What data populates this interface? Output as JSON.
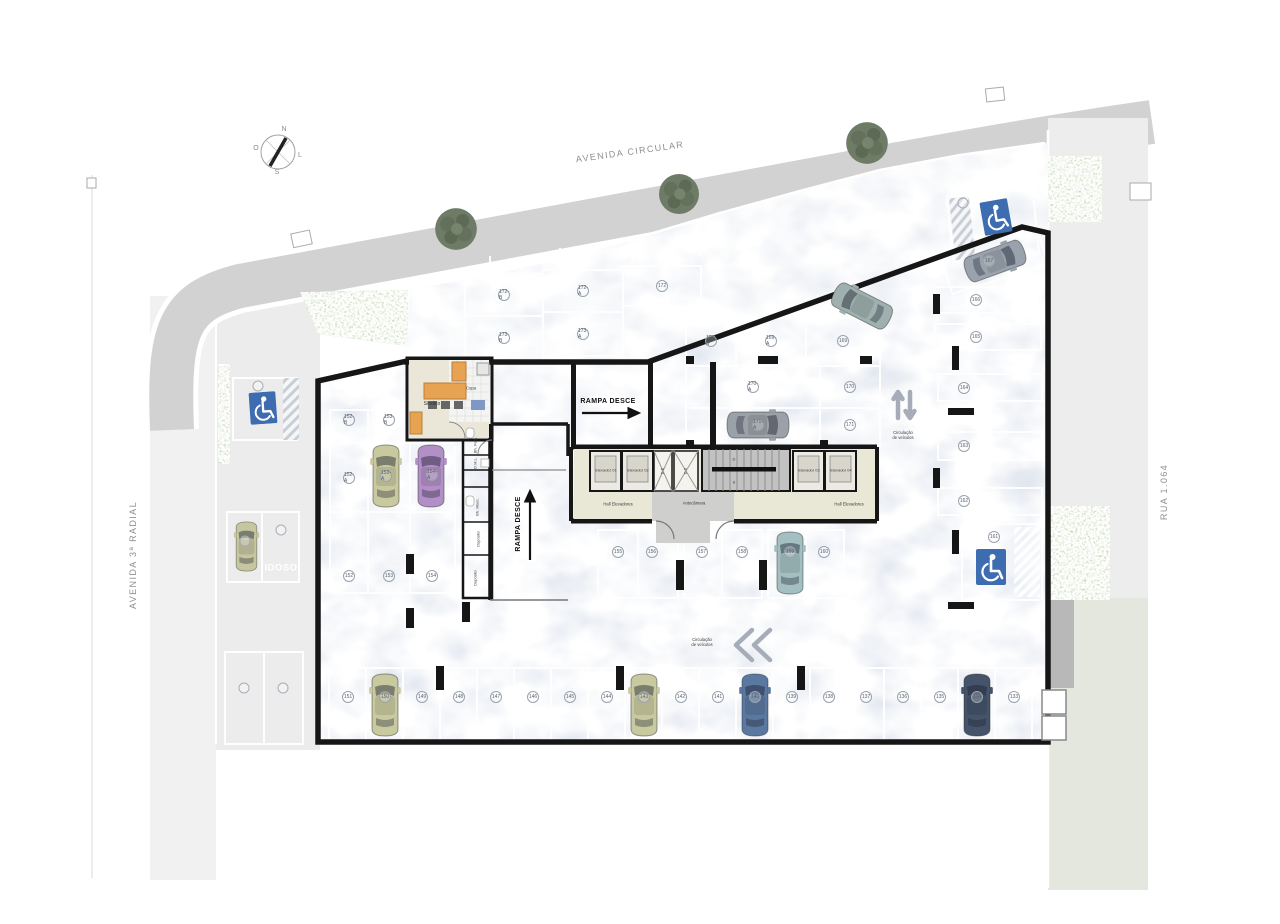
{
  "streets": {
    "top": "AVENIDA CIRCULAR",
    "left": "AVENIDA 3ª RADIAL",
    "right": "RUA 1.064"
  },
  "compass": {
    "n": "N",
    "s": "S",
    "o": "O",
    "l": "L"
  },
  "ramps": {
    "down1": "RAMPA DESCE",
    "down2": "RAMPA DESCE"
  },
  "circulation": {
    "right": "Circulação\nde veículos",
    "bottom": "Circulação\nde veículos"
  },
  "rooms": {
    "sindico": "Síndico",
    "copa": "Copa",
    "bh_fem": "Bh. Fem.",
    "dml": "D.M.L.",
    "bh_masc": "Bh. Masc.",
    "deposito1": "Depósito",
    "deposito2": "Depósito"
  },
  "core": {
    "elev1": "Elevador 01",
    "elev2": "Elevador 02",
    "elev3": "Elevador 03",
    "elev4": "Elevador 04",
    "hall1": "Hall Elevadores",
    "hall2": "Hall Elevadores",
    "antecamara": "Antecâmara",
    "duct_e": "D.E",
    "duct_s": "D.S",
    "stair_down": "D",
    "stair_up": "S"
  },
  "special": {
    "idoso": "IDOSO"
  },
  "spots": {
    "bottom": [
      "151",
      "150",
      "149",
      "148",
      "147",
      "146",
      "145",
      "144",
      "143",
      "142",
      "141",
      "140",
      "139",
      "138",
      "137",
      "136",
      "135",
      "134",
      "133"
    ],
    "mid": [
      "155",
      "156",
      "157",
      "158",
      "159",
      "160"
    ],
    "right": [
      "167",
      "166",
      "165",
      "164",
      "163",
      "162",
      "161"
    ],
    "band": [
      "169-B",
      "169-A",
      "169",
      "170-A",
      "170",
      "171-A",
      "171"
    ],
    "deck": [
      "172-B",
      "172-A",
      "172",
      "173-B",
      "173-A"
    ],
    "left": [
      "152-B",
      "153-B",
      "152-A",
      "153-A",
      "154-A",
      "152",
      "153",
      "154"
    ]
  },
  "colors": {
    "deck": "#d7deea",
    "road": "#d2d2d2",
    "grass": "#a3c57c",
    "wall": "#161616",
    "accessible_blue": "#3e6cb0",
    "car_beige": "#c9c9a0",
    "car_purple": "#b28fc6",
    "car_teal": "#a3bfc1",
    "car_blue": "#5b79a0",
    "car_navy": "#45546b",
    "car_gray": "#9ba1a8"
  }
}
